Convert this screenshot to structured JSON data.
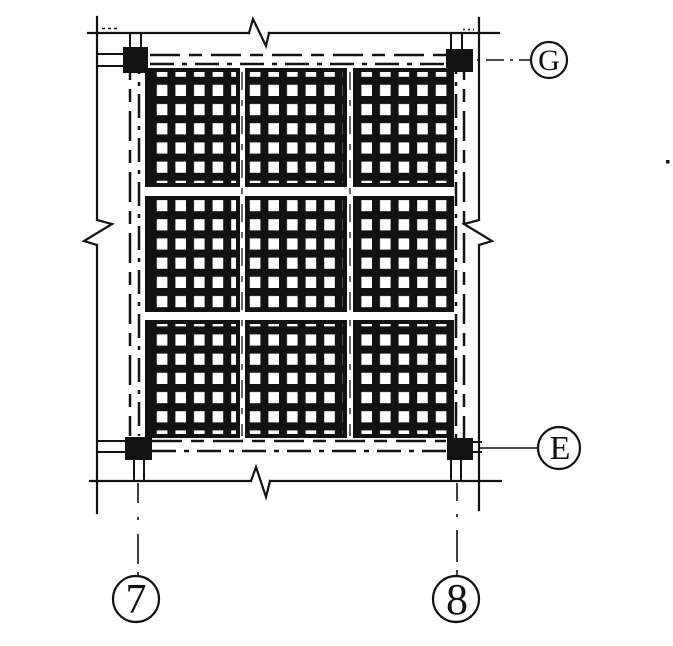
{
  "colors": {
    "paper": "#ffffff",
    "ink": "#121212"
  },
  "plan": {
    "horizontal_grid_bubbles": [
      {
        "label": "G"
      },
      {
        "label": "E"
      }
    ],
    "vertical_grid_bubbles": [
      {
        "label": "7"
      },
      {
        "label": "8"
      }
    ],
    "waffle_panels": {
      "rows": 3,
      "cols": 3
    },
    "columns_count": 4
  }
}
